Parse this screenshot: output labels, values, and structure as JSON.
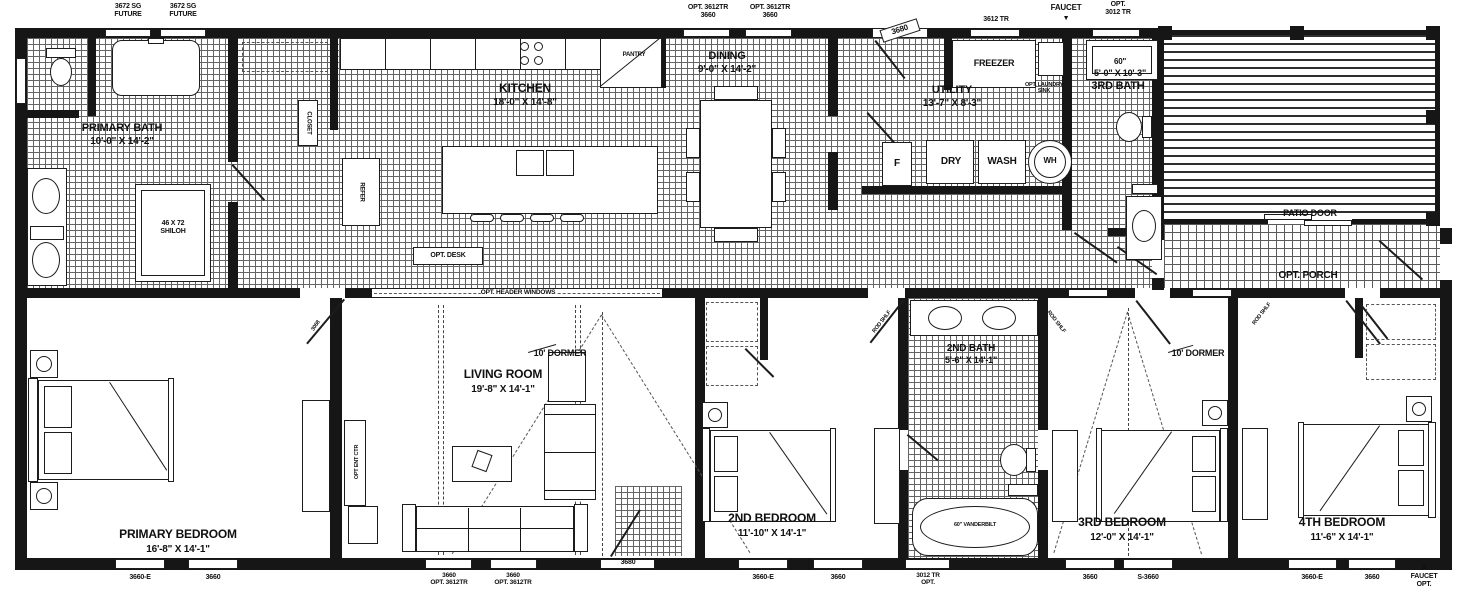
{
  "rooms": [
    {
      "id": "primary-bath",
      "label": "PRIMARY BATH",
      "dims": "10'-0\" X 14'-2\""
    },
    {
      "id": "kitchen",
      "label": "KITCHEN",
      "dims": "18'-0\" X 14'-8\""
    },
    {
      "id": "dining",
      "label": "DINING",
      "dims": "9'-0\" X 14'-2\""
    },
    {
      "id": "utility",
      "label": "UTILITY",
      "dims": "13'-7\" X 8'-3\""
    },
    {
      "id": "third-bath",
      "label": "3RD BATH",
      "dims": "5'-0\" X 10'-3\"",
      "size_note": "60\""
    },
    {
      "id": "living-room",
      "label": "LIVING ROOM",
      "dims": "19'-8\" X 14'-1\""
    },
    {
      "id": "primary-bedroom",
      "label": "PRIMARY BEDROOM",
      "dims": "16'-8\" X 14'-1\""
    },
    {
      "id": "second-bedroom",
      "label": "2ND BEDROOM",
      "dims": "11'-10\" X 14'-1\""
    },
    {
      "id": "second-bath",
      "label": "2ND BATH",
      "dims": "5'-6\" X 14'-1\""
    },
    {
      "id": "third-bedroom",
      "label": "3RD BEDROOM",
      "dims": "12'-0\" X 14'-1\""
    },
    {
      "id": "fourth-bedroom",
      "label": "4TH BEDROOM",
      "dims": "11'-6\" X 14'-1\""
    }
  ],
  "fixtures": {
    "freezer": "FREEZER",
    "laundry_sink": "OPT. LAUNDRY\nSINK",
    "furnace": "F",
    "dryer": "DRY",
    "washer": "WASH",
    "water_heater": "WH",
    "shower": "46 X 72\nSHILOH",
    "closet": "CLOSET",
    "refrigerator": "REFER",
    "pantry": "PANTRY",
    "tub": "60\" VANDERBILT",
    "ent_center": "OPT ENT CTR",
    "desk": "OPT. DESK",
    "patio_door": "PATIO DOOR",
    "opt_porch": "OPT. PORCH",
    "header_windows": "OPT. HEADER WINDOWS",
    "dormer_living": "10' DORMER",
    "dormer_third": "10' DORMER"
  },
  "openings": {
    "top": [
      {
        "id": "future-window-1",
        "label": "3672 SG\nFUTURE"
      },
      {
        "id": "future-window-2",
        "label": "3672 SG\nFUTURE"
      },
      {
        "id": "dining-window-1",
        "label": "OPT. 3612TR\n3660"
      },
      {
        "id": "dining-window-2",
        "label": "OPT. 3612TR\n3660"
      },
      {
        "id": "back-door",
        "label": "3680"
      },
      {
        "id": "utility-window",
        "label": "3612 TR"
      },
      {
        "id": "bath3-window",
        "label": "OPT.\n3012 TR"
      }
    ],
    "bottom": [
      {
        "id": "primary-window-1",
        "label": "3660-E"
      },
      {
        "id": "primary-window-2",
        "label": "3660"
      },
      {
        "id": "living-window-1",
        "label": "3660\nOPT. 3612TR"
      },
      {
        "id": "living-window-2",
        "label": "3660\nOPT. 3612TR"
      },
      {
        "id": "front-door",
        "label": "3680"
      },
      {
        "id": "bed2-window-1",
        "label": "3660-E"
      },
      {
        "id": "bed2-window-2",
        "label": "3660"
      },
      {
        "id": "bath2-window",
        "label": "3012 TR\nOPT."
      },
      {
        "id": "bed3-window-1",
        "label": "3660"
      },
      {
        "id": "bed3-window-2",
        "label": "S-3660"
      },
      {
        "id": "bed4-window-1",
        "label": "3660-E"
      },
      {
        "id": "bed4-window-2",
        "label": "3660"
      }
    ]
  },
  "annotations": {
    "faucet_top": "FAUCET",
    "faucet_top_arrow": "▼",
    "faucet_bottom": "FAUCET\nOPT.",
    "faucet_bottom_arrow": "▲",
    "rod_shelf": "ROD SHLF",
    "door_primary": "3068"
  }
}
